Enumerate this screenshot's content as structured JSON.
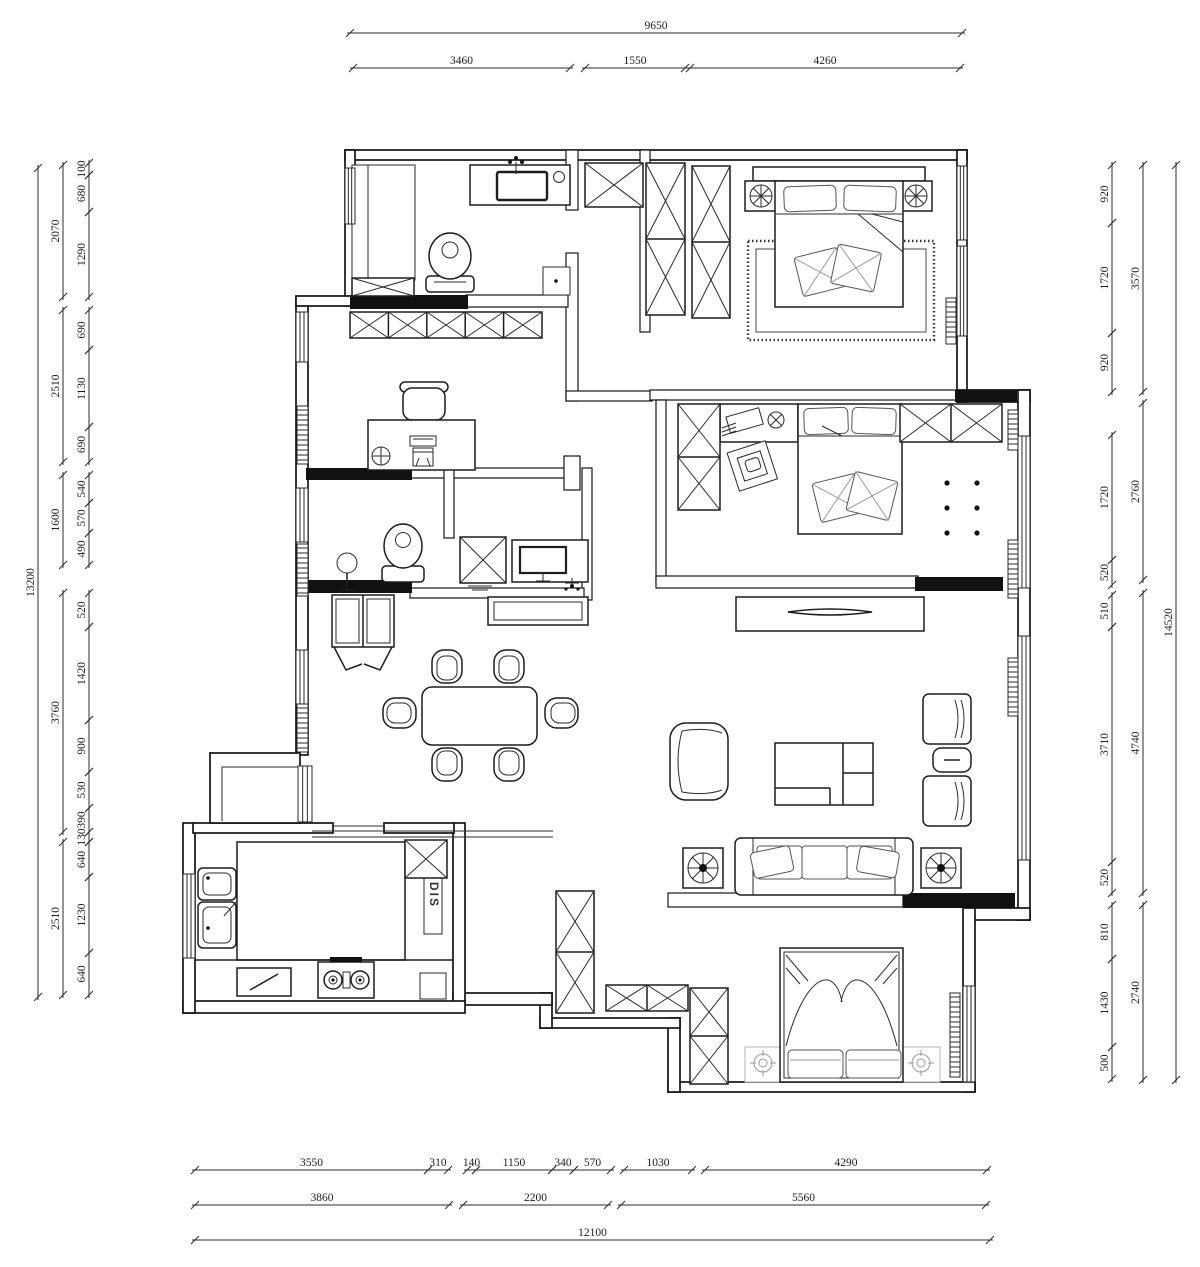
{
  "title": "apartment-floor-plan",
  "colors": {
    "line": "#141414",
    "background": "#ffffff"
  },
  "labels": {
    "dis": "DIS"
  },
  "dimensions": {
    "top_overall": [
      "9650"
    ],
    "top_row": [
      "3460",
      "1550",
      "4260"
    ],
    "left_overall": [
      "13200"
    ],
    "left_mid": [
      "2070",
      "2510",
      "1600",
      "3760",
      "2510"
    ],
    "left_inner": [
      "100",
      "680",
      "1290",
      "690",
      "1130",
      "690",
      "540",
      "570",
      "490",
      "520",
      "1420",
      "900",
      "530",
      "390",
      "130",
      "640",
      "1230",
      "640"
    ],
    "right_overall": [
      "14520"
    ],
    "right_mid": [
      "3570",
      "2760",
      "4740",
      "2740"
    ],
    "right_inner": [
      "920",
      "1720",
      "920",
      "1720",
      "520",
      "510",
      "3710",
      "520",
      "810",
      "1430",
      "500"
    ],
    "bottom_row1": [
      "3550",
      "310",
      "140",
      "1150",
      "340",
      "570",
      "1030",
      "4290"
    ],
    "bottom_row2": [
      "3860",
      "2200",
      "5560"
    ],
    "bottom_overall": [
      "12100"
    ]
  }
}
